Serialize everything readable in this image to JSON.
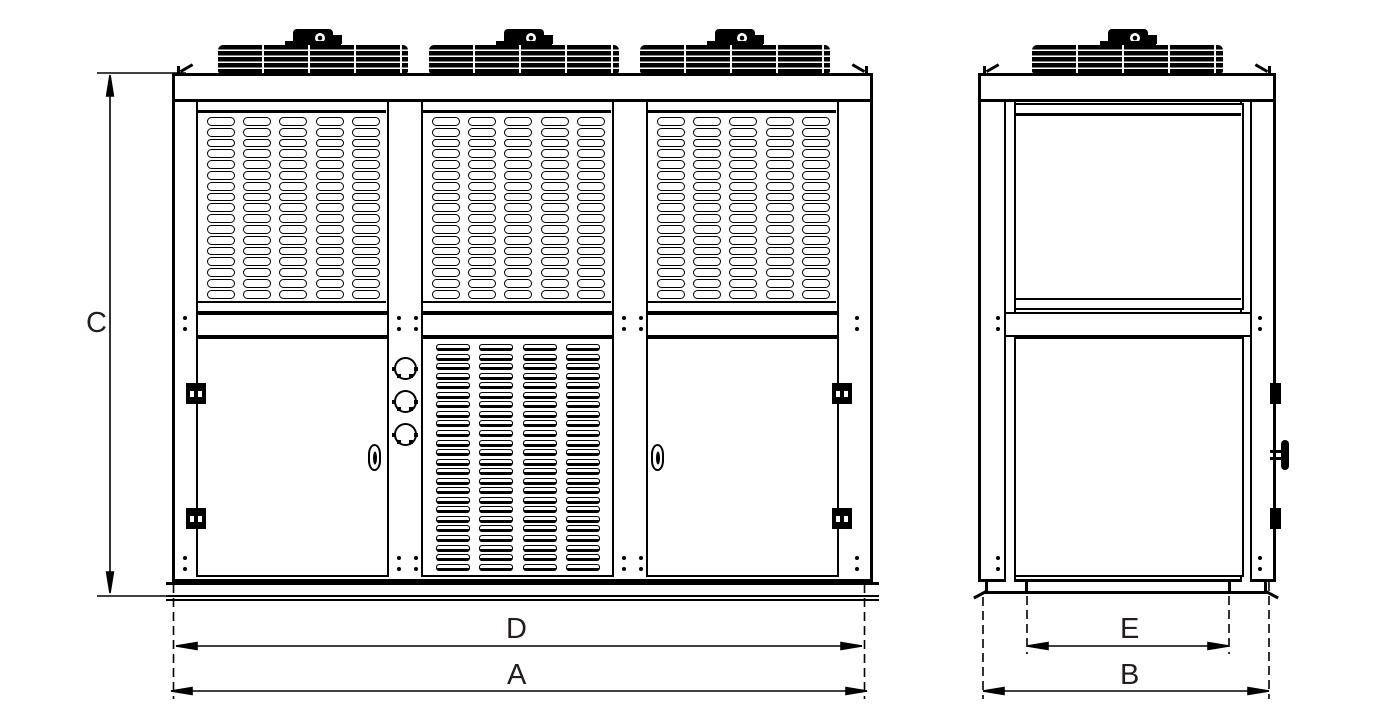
{
  "drawing": {
    "kind": "condensing-unit-elevation-drawing",
    "background": "#ffffff",
    "line_color": "#000000",
    "label_color": "#241c1e"
  },
  "dimension_labels": {
    "height": "C",
    "front_inner_width": "D",
    "front_overall_width": "A",
    "side_inner_depth": "E",
    "side_overall_depth": "B"
  },
  "front_view": {
    "fan_units": 3,
    "grille_bays": 3,
    "grille_columns_per_bay": 5,
    "grille_rows_per_bay": 17,
    "louver_columns": 4,
    "louver_rows": 24,
    "doors": 2,
    "gland_knobs": 3
  },
  "side_view": {
    "fan_units": 1,
    "blank_panels": 2
  }
}
